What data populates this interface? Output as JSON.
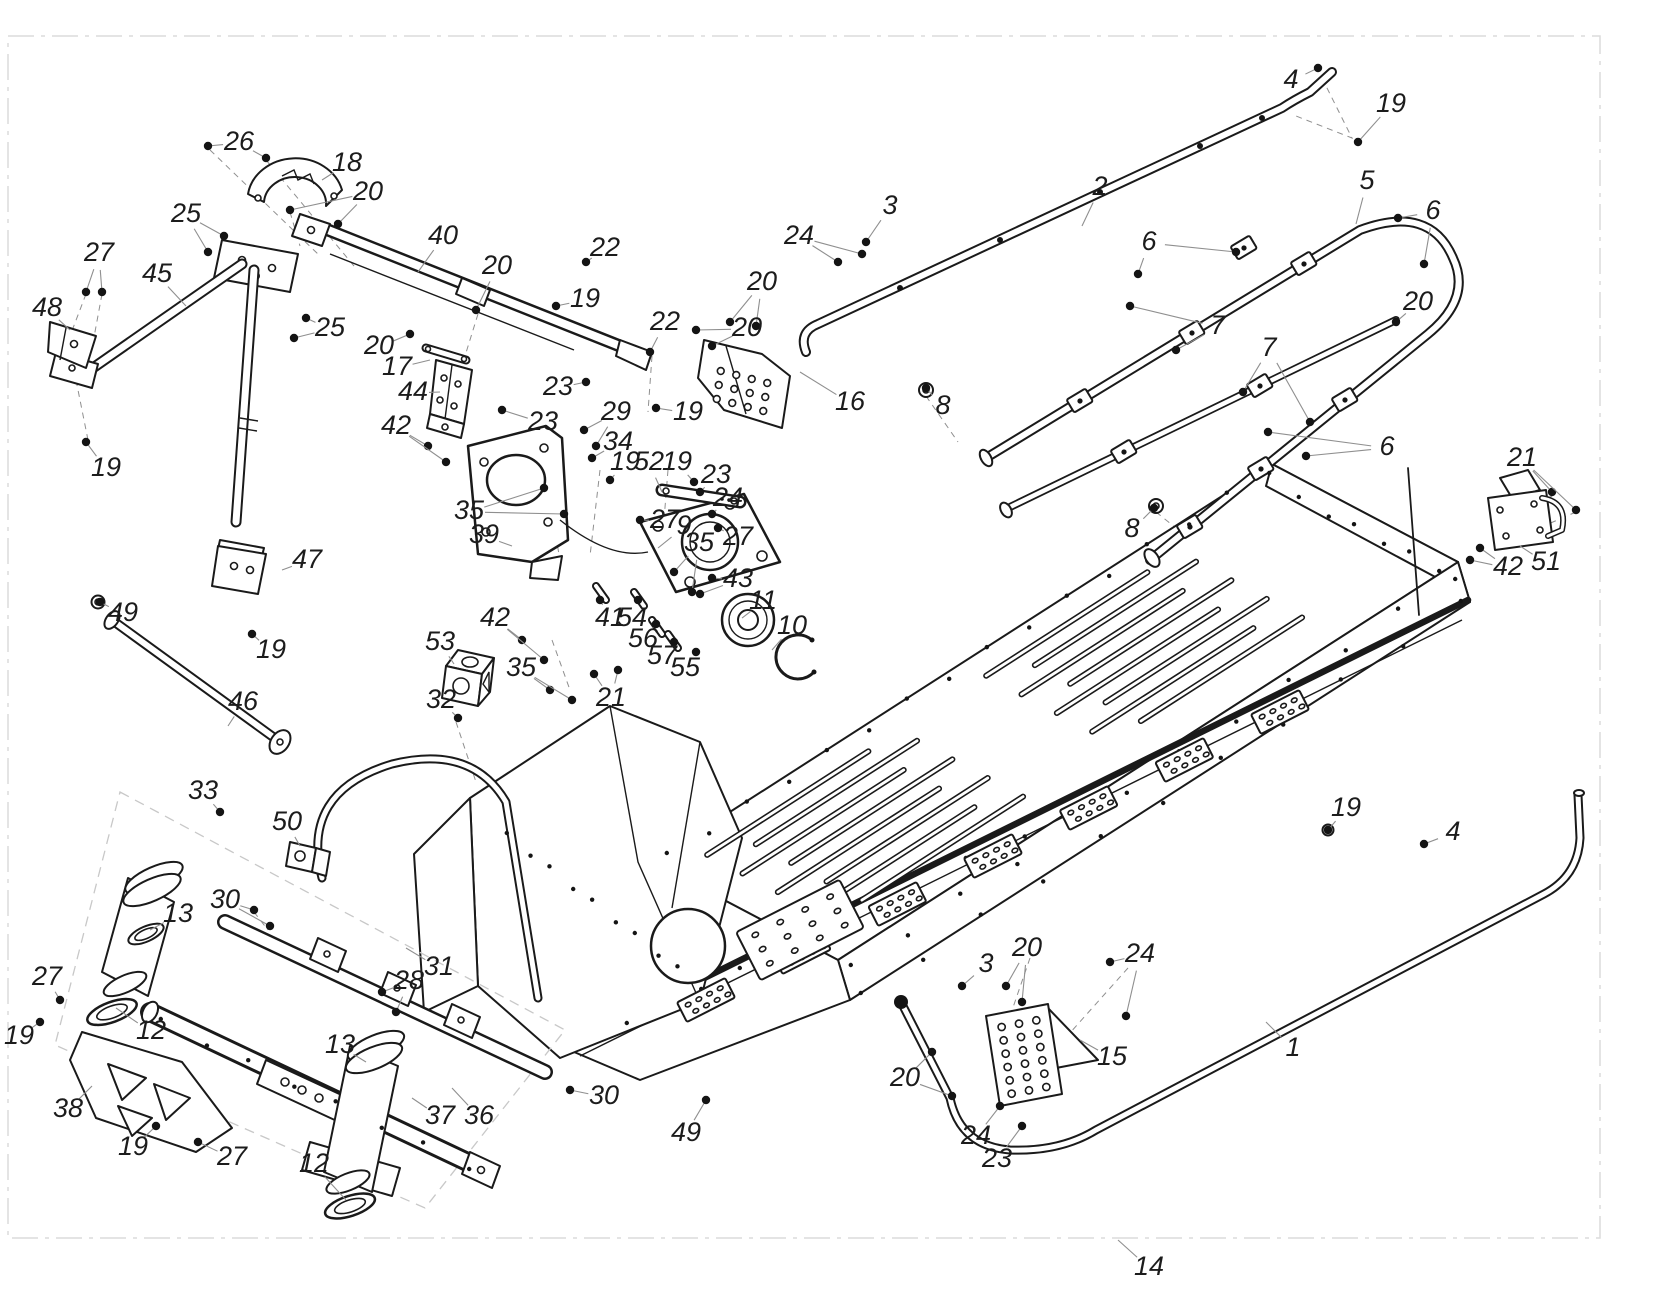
{
  "figure": {
    "type": "exploded-parts-diagram",
    "canvas": {
      "width": 1673,
      "height": 1311
    },
    "colors": {
      "background": "#ffffff",
      "line": "#1a1a1a",
      "leader": "#8f8f8f",
      "border": "#dcdcdc",
      "text": "#1c1c1c"
    },
    "label_font_size": 27
  },
  "callouts": [
    {
      "n": "4",
      "x": 1291,
      "y": 81,
      "l": [
        [
          1318,
          68
        ]
      ],
      "d": 1
    },
    {
      "n": "19",
      "x": 1391,
      "y": 105,
      "l": [
        [
          1358,
          142
        ]
      ],
      "d": 1
    },
    {
      "n": "26",
      "x": 239,
      "y": 143,
      "l": [
        [
          208,
          146
        ],
        [
          266,
          158
        ]
      ],
      "d": 1
    },
    {
      "n": "18",
      "x": 347,
      "y": 164,
      "l": [
        [
          322,
          180
        ]
      ],
      "d": 0
    },
    {
      "n": "20",
      "x": 368,
      "y": 193,
      "l": [
        [
          290,
          210
        ],
        [
          338,
          224
        ]
      ],
      "d": 1
    },
    {
      "n": "2",
      "x": 1100,
      "y": 188,
      "l": [
        [
          1082,
          226
        ]
      ],
      "d": 0
    },
    {
      "n": "5",
      "x": 1367,
      "y": 182,
      "l": [
        [
          1356,
          224
        ]
      ],
      "d": 0
    },
    {
      "n": "25",
      "x": 186,
      "y": 215,
      "l": [
        [
          224,
          236
        ],
        [
          208,
          252
        ]
      ],
      "d": 1
    },
    {
      "n": "3",
      "x": 890,
      "y": 207,
      "l": [
        [
          866,
          242
        ]
      ],
      "d": 1
    },
    {
      "n": "24",
      "x": 799,
      "y": 237,
      "l": [
        [
          838,
          262
        ],
        [
          862,
          254
        ]
      ],
      "d": 1
    },
    {
      "n": "6",
      "x": 1433,
      "y": 212,
      "l": [
        [
          1398,
          218
        ],
        [
          1424,
          264
        ]
      ],
      "d": 1
    },
    {
      "n": "40",
      "x": 443,
      "y": 237,
      "l": [
        [
          418,
          272
        ]
      ],
      "d": 0
    },
    {
      "n": "6",
      "x": 1149,
      "y": 243,
      "l": [
        [
          1236,
          252
        ],
        [
          1138,
          274
        ]
      ],
      "d": 1
    },
    {
      "n": "22",
      "x": 605,
      "y": 249,
      "l": [
        [
          586,
          262
        ]
      ],
      "d": 1
    },
    {
      "n": "27",
      "x": 99,
      "y": 254,
      "l": [
        [
          86,
          292
        ],
        [
          102,
          292
        ]
      ],
      "d": 1
    },
    {
      "n": "20",
      "x": 497,
      "y": 267,
      "l": [
        [
          476,
          310
        ]
      ],
      "d": 1
    },
    {
      "n": "45",
      "x": 157,
      "y": 275,
      "l": [
        [
          186,
          306
        ]
      ],
      "d": 0
    },
    {
      "n": "20",
      "x": 762,
      "y": 283,
      "l": [
        [
          730,
          322
        ],
        [
          756,
          326
        ]
      ],
      "d": 1
    },
    {
      "n": "19",
      "x": 585,
      "y": 300,
      "l": [
        [
          556,
          306
        ]
      ],
      "d": 1
    },
    {
      "n": "48",
      "x": 47,
      "y": 309,
      "l": [
        [
          70,
          330
        ]
      ],
      "d": 0
    },
    {
      "n": "20",
      "x": 1418,
      "y": 303,
      "l": [
        [
          1396,
          322
        ]
      ],
      "d": 1
    },
    {
      "n": "22",
      "x": 665,
      "y": 323,
      "l": [
        [
          650,
          352
        ]
      ],
      "d": 1
    },
    {
      "n": "7",
      "x": 1218,
      "y": 327,
      "l": [
        [
          1130,
          306
        ],
        [
          1176,
          350
        ]
      ],
      "d": 1
    },
    {
      "n": "25",
      "x": 330,
      "y": 329,
      "l": [
        [
          306,
          318
        ],
        [
          294,
          338
        ]
      ],
      "d": 1
    },
    {
      "n": "20",
      "x": 747,
      "y": 329,
      "l": [
        [
          696,
          330
        ],
        [
          712,
          346
        ]
      ],
      "d": 1
    },
    {
      "n": "7",
      "x": 1269,
      "y": 349,
      "l": [
        [
          1243,
          392
        ],
        [
          1310,
          422
        ]
      ],
      "d": 1
    },
    {
      "n": "20",
      "x": 379,
      "y": 347,
      "l": [
        [
          410,
          334
        ]
      ],
      "d": 1
    },
    {
      "n": "17",
      "x": 397,
      "y": 368,
      "l": [
        [
          430,
          360
        ]
      ],
      "d": 0
    },
    {
      "n": "23",
      "x": 558,
      "y": 388,
      "l": [
        [
          586,
          382
        ]
      ],
      "d": 1
    },
    {
      "n": "44",
      "x": 413,
      "y": 393,
      "l": [
        [
          440,
          392
        ]
      ],
      "d": 0
    },
    {
      "n": "16",
      "x": 850,
      "y": 403,
      "l": [
        [
          800,
          372
        ]
      ],
      "d": 0
    },
    {
      "n": "8",
      "x": 943,
      "y": 407,
      "l": [
        [
          926,
          388
        ]
      ],
      "d": 1
    },
    {
      "n": "29",
      "x": 616,
      "y": 413,
      "l": [
        [
          584,
          430
        ],
        [
          596,
          446
        ]
      ],
      "d": 1
    },
    {
      "n": "19",
      "x": 688,
      "y": 413,
      "l": [
        [
          656,
          408
        ]
      ],
      "d": 1
    },
    {
      "n": "23",
      "x": 543,
      "y": 423,
      "l": [
        [
          502,
          410
        ]
      ],
      "d": 1
    },
    {
      "n": "42",
      "x": 396,
      "y": 427,
      "l": [
        [
          428,
          446
        ],
        [
          446,
          462
        ]
      ],
      "d": 1
    },
    {
      "n": "34",
      "x": 618,
      "y": 443,
      "l": [
        [
          592,
          458
        ]
      ],
      "d": 1
    },
    {
      "n": "6",
      "x": 1387,
      "y": 448,
      "l": [
        [
          1306,
          456
        ],
        [
          1268,
          432
        ]
      ],
      "d": 1
    },
    {
      "n": "21",
      "x": 1522,
      "y": 459,
      "l": [
        [
          1552,
          492
        ],
        [
          1576,
          510
        ]
      ],
      "d": 1
    },
    {
      "n": "19",
      "x": 625,
      "y": 463,
      "l": [
        [
          610,
          480
        ]
      ],
      "d": 1
    },
    {
      "n": "52",
      "x": 649,
      "y": 463,
      "l": [
        [
          662,
          492
        ]
      ],
      "d": 0
    },
    {
      "n": "19",
      "x": 677,
      "y": 463,
      "l": [
        [
          694,
          482
        ]
      ],
      "d": 1
    },
    {
      "n": "19",
      "x": 106,
      "y": 469,
      "l": [
        [
          86,
          442
        ]
      ],
      "d": 1
    },
    {
      "n": "23",
      "x": 716,
      "y": 476,
      "l": [
        [
          700,
          492
        ]
      ],
      "d": 1
    },
    {
      "n": "24",
      "x": 728,
      "y": 499,
      "l": [
        [
          712,
          514
        ]
      ],
      "d": 1
    },
    {
      "n": "35",
      "x": 469,
      "y": 512,
      "l": [
        [
          544,
          488
        ],
        [
          564,
          514
        ]
      ],
      "d": 1
    },
    {
      "n": "27",
      "x": 665,
      "y": 521,
      "l": [
        [
          640,
          520
        ]
      ],
      "d": 1
    },
    {
      "n": "9",
      "x": 684,
      "y": 527,
      "l": [
        [
          658,
          548
        ]
      ],
      "d": 0
    },
    {
      "n": "8",
      "x": 1132,
      "y": 530,
      "l": [
        [
          1154,
          508
        ]
      ],
      "d": 1
    },
    {
      "n": "39",
      "x": 484,
      "y": 536,
      "l": [
        [
          512,
          546
        ]
      ],
      "d": 0
    },
    {
      "n": "27",
      "x": 738,
      "y": 538,
      "l": [
        [
          718,
          528
        ]
      ],
      "d": 1
    },
    {
      "n": "35",
      "x": 699,
      "y": 544,
      "l": [
        [
          674,
          572
        ],
        [
          692,
          592
        ]
      ],
      "d": 1
    },
    {
      "n": "47",
      "x": 307,
      "y": 561,
      "l": [
        [
          282,
          570
        ]
      ],
      "d": 0
    },
    {
      "n": "51",
      "x": 1546,
      "y": 563,
      "l": [
        [
          1520,
          546
        ]
      ],
      "d": 0
    },
    {
      "n": "42",
      "x": 1508,
      "y": 568,
      "l": [
        [
          1480,
          548
        ],
        [
          1470,
          560
        ]
      ],
      "d": 1
    },
    {
      "n": "43",
      "x": 738,
      "y": 580,
      "l": [
        [
          712,
          578
        ],
        [
          700,
          594
        ]
      ],
      "d": 1
    },
    {
      "n": "11",
      "x": 763,
      "y": 602,
      "l": [
        [
          742,
          618
        ]
      ],
      "d": 0
    },
    {
      "n": "10",
      "x": 792,
      "y": 627,
      "l": [
        [
          772,
          650
        ]
      ],
      "d": 0
    },
    {
      "n": "41",
      "x": 610,
      "y": 619,
      "l": [
        [
          600,
          600
        ]
      ],
      "d": 1
    },
    {
      "n": "54",
      "x": 632,
      "y": 619,
      "l": [
        [
          638,
          600
        ]
      ],
      "d": 1
    },
    {
      "n": "49",
      "x": 123,
      "y": 614,
      "l": [
        [
          100,
          602
        ]
      ],
      "d": 1
    },
    {
      "n": "42",
      "x": 495,
      "y": 619,
      "l": [
        [
          522,
          640
        ],
        [
          544,
          660
        ]
      ],
      "d": 1
    },
    {
      "n": "56",
      "x": 643,
      "y": 640,
      "l": [
        [
          656,
          624
        ]
      ],
      "d": 1
    },
    {
      "n": "53",
      "x": 440,
      "y": 643,
      "l": [
        [
          454,
          664
        ]
      ],
      "d": 0
    },
    {
      "n": "19",
      "x": 271,
      "y": 651,
      "l": [
        [
          252,
          634
        ]
      ],
      "d": 1
    },
    {
      "n": "57",
      "x": 662,
      "y": 657,
      "l": [
        [
          674,
          642
        ]
      ],
      "d": 1
    },
    {
      "n": "35",
      "x": 521,
      "y": 669,
      "l": [
        [
          550,
          690
        ],
        [
          572,
          700
        ]
      ],
      "d": 1
    },
    {
      "n": "55",
      "x": 685,
      "y": 669,
      "l": [
        [
          696,
          652
        ]
      ],
      "d": 1
    },
    {
      "n": "21",
      "x": 611,
      "y": 699,
      "l": [
        [
          594,
          674
        ],
        [
          618,
          670
        ]
      ],
      "d": 1
    },
    {
      "n": "46",
      "x": 243,
      "y": 703,
      "l": [
        [
          228,
          726
        ]
      ],
      "d": 0
    },
    {
      "n": "32",
      "x": 441,
      "y": 701,
      "l": [
        [
          458,
          718
        ]
      ],
      "d": 1
    },
    {
      "n": "19",
      "x": 1346,
      "y": 809,
      "l": [
        [
          1328,
          830
        ]
      ],
      "d": 1
    },
    {
      "n": "33",
      "x": 203,
      "y": 792,
      "l": [
        [
          220,
          812
        ]
      ],
      "d": 1
    },
    {
      "n": "50",
      "x": 287,
      "y": 823,
      "l": [
        [
          300,
          846
        ]
      ],
      "d": 0
    },
    {
      "n": "4",
      "x": 1453,
      "y": 833,
      "l": [
        [
          1424,
          844
        ]
      ],
      "d": 1
    },
    {
      "n": "30",
      "x": 225,
      "y": 901,
      "l": [
        [
          254,
          910
        ],
        [
          270,
          926
        ]
      ],
      "d": 1
    },
    {
      "n": "13",
      "x": 178,
      "y": 915,
      "l": [
        [
          150,
          930
        ]
      ],
      "d": 0
    },
    {
      "n": "31",
      "x": 439,
      "y": 968,
      "l": [
        [
          406,
          948
        ]
      ],
      "d": 0
    },
    {
      "n": "28",
      "x": 409,
      "y": 982,
      "l": [
        [
          382,
          992
        ],
        [
          396,
          1012
        ]
      ],
      "d": 1
    },
    {
      "n": "3",
      "x": 986,
      "y": 965,
      "l": [
        [
          962,
          986
        ]
      ],
      "d": 1
    },
    {
      "n": "20",
      "x": 1027,
      "y": 949,
      "l": [
        [
          1006,
          986
        ],
        [
          1022,
          1002
        ]
      ],
      "d": 1
    },
    {
      "n": "24",
      "x": 1140,
      "y": 955,
      "l": [
        [
          1110,
          962
        ],
        [
          1126,
          1016
        ]
      ],
      "d": 1
    },
    {
      "n": "27",
      "x": 47,
      "y": 978,
      "l": [
        [
          60,
          1000
        ]
      ],
      "d": 1
    },
    {
      "n": "19",
      "x": 19,
      "y": 1037,
      "l": [
        [
          40,
          1022
        ]
      ],
      "d": 1
    },
    {
      "n": "12",
      "x": 151,
      "y": 1032,
      "l": [
        [
          116,
          1008
        ]
      ],
      "d": 0
    },
    {
      "n": "13",
      "x": 340,
      "y": 1046,
      "l": [
        [
          366,
          1062
        ]
      ],
      "d": 0
    },
    {
      "n": "1",
      "x": 1293,
      "y": 1049,
      "l": [
        [
          1266,
          1022
        ]
      ],
      "d": 0
    },
    {
      "n": "15",
      "x": 1112,
      "y": 1058,
      "l": [
        [
          1080,
          1040
        ]
      ],
      "d": 0
    },
    {
      "n": "20",
      "x": 905,
      "y": 1079,
      "l": [
        [
          932,
          1052
        ],
        [
          952,
          1096
        ]
      ],
      "d": 1
    },
    {
      "n": "30",
      "x": 604,
      "y": 1097,
      "l": [
        [
          570,
          1090
        ]
      ],
      "d": 1
    },
    {
      "n": "38",
      "x": 68,
      "y": 1110,
      "l": [
        [
          92,
          1086
        ]
      ],
      "d": 0
    },
    {
      "n": "37",
      "x": 440,
      "y": 1117,
      "l": [
        [
          412,
          1098
        ]
      ],
      "d": 0
    },
    {
      "n": "36",
      "x": 479,
      "y": 1117,
      "l": [
        [
          452,
          1088
        ]
      ],
      "d": 0
    },
    {
      "n": "49",
      "x": 686,
      "y": 1134,
      "l": [
        [
          706,
          1100
        ]
      ],
      "d": 1
    },
    {
      "n": "24",
      "x": 976,
      "y": 1137,
      "l": [
        [
          1000,
          1106
        ]
      ],
      "d": 1
    },
    {
      "n": "12",
      "x": 314,
      "y": 1165,
      "l": [
        [
          346,
          1200
        ]
      ],
      "d": 0
    },
    {
      "n": "19",
      "x": 133,
      "y": 1148,
      "l": [
        [
          156,
          1126
        ]
      ],
      "d": 1
    },
    {
      "n": "27",
      "x": 232,
      "y": 1158,
      "l": [
        [
          198,
          1142
        ]
      ],
      "d": 1
    },
    {
      "n": "23",
      "x": 997,
      "y": 1160,
      "l": [
        [
          1022,
          1126
        ]
      ],
      "d": 1
    },
    {
      "n": "14",
      "x": 1149,
      "y": 1268,
      "l": [
        [
          1118,
          1240
        ]
      ],
      "d": 0
    }
  ]
}
